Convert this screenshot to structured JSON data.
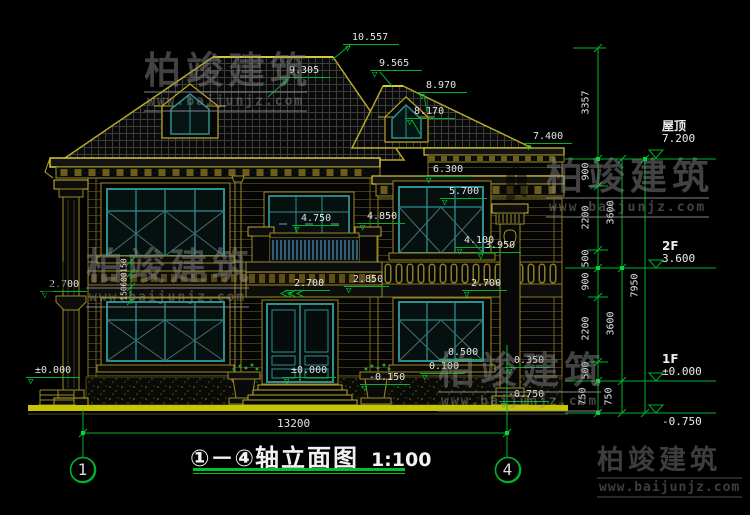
{
  "drawing": {
    "title": {
      "axes": "①－④",
      "name": "轴立面图",
      "scale": "1:100"
    },
    "overall_width_dim": "13200",
    "grid_bubbles": [
      {
        "label": "1"
      },
      {
        "label": "4"
      }
    ],
    "levels": [
      {
        "name": "屋顶",
        "value": "7.200"
      },
      {
        "name": "2F",
        "value": "3.600"
      },
      {
        "name": "1F",
        "value": "±0.000"
      },
      {
        "name": "",
        "value": "-0.750"
      }
    ],
    "elevation_markers": [
      {
        "label": "10.557",
        "x": 343,
        "y": 33,
        "w": 56
      },
      {
        "label": "9.305",
        "x": 280,
        "y": 66,
        "w": 50
      },
      {
        "label": "9.565",
        "x": 370,
        "y": 59,
        "w": 52
      },
      {
        "label": "8.970",
        "x": 417,
        "y": 81,
        "w": 50
      },
      {
        "label": "8.170",
        "x": 405,
        "y": 107,
        "w": 50
      },
      {
        "label": "7.400",
        "x": 524,
        "y": 132,
        "w": 48
      },
      {
        "label": "6.300",
        "x": 424,
        "y": 165,
        "w": 47
      },
      {
        "label": "5.700",
        "x": 440,
        "y": 187,
        "w": 47
      },
      {
        "label": "4.750",
        "x": 292,
        "y": 214,
        "w": 47
      },
      {
        "label": "4.850",
        "x": 358,
        "y": 212,
        "w": 47
      },
      {
        "label": "4.100",
        "x": 455,
        "y": 236,
        "w": 45
      },
      {
        "label": "3.950",
        "x": 476,
        "y": 241,
        "w": 45
      },
      {
        "label": "2.850",
        "x": 344,
        "y": 275,
        "w": 45
      },
      {
        "label": "2.700",
        "x": 285,
        "y": 279,
        "w": 45
      },
      {
        "label": "2.700",
        "x": 40,
        "y": 280,
        "w": 47
      },
      {
        "label": "2.700",
        "x": 462,
        "y": 279,
        "w": 45
      },
      {
        "label": "±0.000",
        "x": 26,
        "y": 366,
        "w": 54
      },
      {
        "label": "±0.000",
        "x": 282,
        "y": 366,
        "w": 54
      },
      {
        "label": "-0.150",
        "x": 360,
        "y": 373,
        "w": 50
      },
      {
        "label": "0.500",
        "x": 439,
        "y": 348,
        "w": 45
      },
      {
        "label": "0.350",
        "x": 505,
        "y": 356,
        "w": 45
      },
      {
        "label": "0.100",
        "x": 420,
        "y": 362,
        "w": 45
      },
      {
        "label": "-0.750",
        "x": 499,
        "y": 390,
        "w": 50
      }
    ],
    "chain_dims": [
      {
        "label": "3357",
        "x": 586,
        "y": 103
      },
      {
        "label": "900",
        "x": 586,
        "y": 172
      },
      {
        "label": "2200",
        "x": 586,
        "y": 218
      },
      {
        "label": "500",
        "x": 586,
        "y": 259
      },
      {
        "label": "900",
        "x": 586,
        "y": 282
      },
      {
        "label": "2200",
        "x": 586,
        "y": 329
      },
      {
        "label": "500",
        "x": 586,
        "y": 371
      },
      {
        "label": "750",
        "x": 583,
        "y": 397
      },
      {
        "label": "3600",
        "x": 611,
        "y": 213
      },
      {
        "label": "3600",
        "x": 611,
        "y": 324
      },
      {
        "label": "750",
        "x": 609,
        "y": 397
      },
      {
        "label": "7950",
        "x": 635,
        "y": 286
      },
      {
        "label": "150",
        "x": 124,
        "y": 267,
        "small": true
      },
      {
        "label": "600",
        "x": 124,
        "y": 281,
        "small": true
      },
      {
        "label": "150",
        "x": 124,
        "y": 295,
        "small": true
      }
    ]
  },
  "branding": {
    "logo_text": "柏竣建筑",
    "logo_url": "www.baijunjz.com"
  },
  "colors": {
    "background": "#000000",
    "line_yellow": "#b8a828",
    "bright_yellow": "#d8c838",
    "dimension_green": "#00b32c",
    "window_teal": "#2e8f8f",
    "text_white": "#e4e4e4",
    "logo_blue": "#1d5fae",
    "logo_orange": "#f29c1f"
  }
}
